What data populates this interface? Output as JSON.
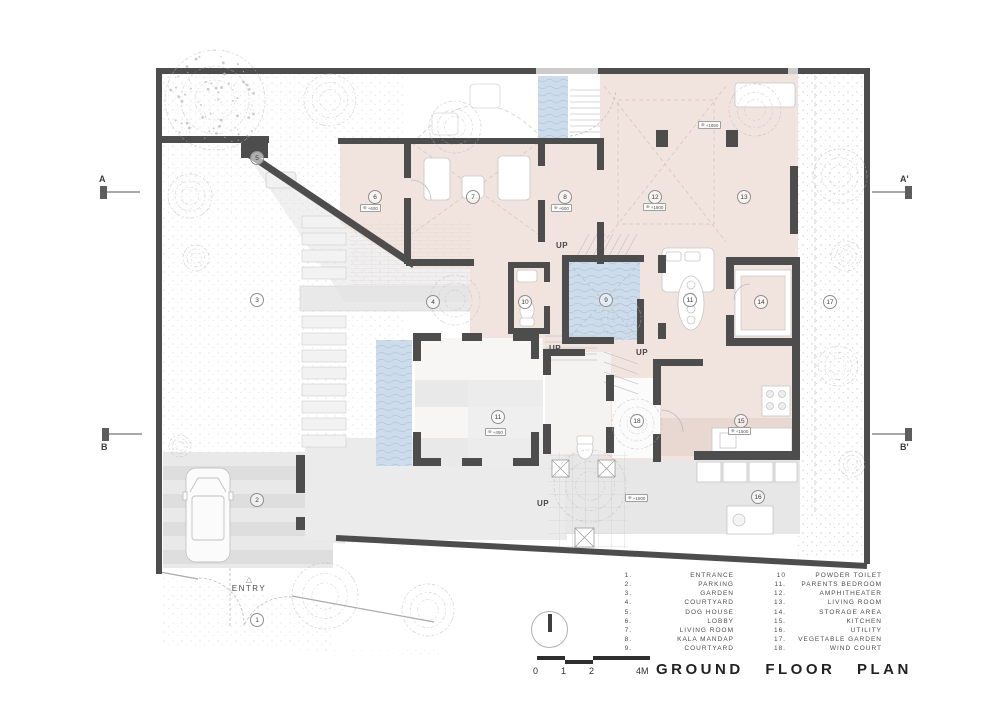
{
  "title": "GROUND FLOOR PLAN",
  "labels": {
    "entry": "ENTRY",
    "up": "UP"
  },
  "colors": {
    "wall": "#4d4d4d",
    "room_fill": "#f1e4df",
    "water": "#cddcea",
    "paving": "#e9e9e9",
    "tree_stroke": "#b8b8b8"
  },
  "section_markers": [
    {
      "label": "A",
      "x": 100,
      "y": 186,
      "side": "left",
      "label_pos": "above"
    },
    {
      "label": "A'",
      "x": 905,
      "y": 186,
      "side": "right",
      "label_pos": "above"
    },
    {
      "label": "B",
      "x": 102,
      "y": 428,
      "side": "left",
      "label_pos": "below"
    },
    {
      "label": "B'",
      "x": 905,
      "y": 428,
      "side": "right",
      "label_pos": "below"
    }
  ],
  "room_markers": [
    {
      "num": "1",
      "x": 257,
      "y": 620
    },
    {
      "num": "2",
      "x": 257,
      "y": 500
    },
    {
      "num": "3",
      "x": 257,
      "y": 300
    },
    {
      "num": "4",
      "x": 433,
      "y": 302
    },
    {
      "num": "5",
      "x": 257,
      "y": 158
    },
    {
      "num": "6",
      "x": 375,
      "y": 197
    },
    {
      "num": "7",
      "x": 473,
      "y": 197
    },
    {
      "num": "8",
      "x": 565,
      "y": 197
    },
    {
      "num": "9",
      "x": 606,
      "y": 300
    },
    {
      "num": "10",
      "x": 525,
      "y": 302
    },
    {
      "num": "11",
      "x": 690,
      "y": 300
    },
    {
      "num": "11",
      "x": 498,
      "y": 417
    },
    {
      "num": "12",
      "x": 655,
      "y": 197
    },
    {
      "num": "13",
      "x": 744,
      "y": 197
    },
    {
      "num": "14",
      "x": 761,
      "y": 302
    },
    {
      "num": "15",
      "x": 741,
      "y": 421
    },
    {
      "num": "16",
      "x": 758,
      "y": 497
    },
    {
      "num": "17",
      "x": 830,
      "y": 302
    },
    {
      "num": "18",
      "x": 637,
      "y": 421
    }
  ],
  "level_tags": [
    {
      "value": "+600",
      "x": 360,
      "y": 204
    },
    {
      "value": "+600",
      "x": 551,
      "y": 204
    },
    {
      "value": "+1800",
      "x": 643,
      "y": 203
    },
    {
      "value": "+1850",
      "x": 698,
      "y": 121
    },
    {
      "value": "+450",
      "x": 485,
      "y": 428
    },
    {
      "value": "+1500",
      "x": 728,
      "y": 427
    },
    {
      "value": "+1500",
      "x": 625,
      "y": 494
    }
  ],
  "up_labels": [
    {
      "x": 556,
      "y": 241
    },
    {
      "x": 549,
      "y": 344
    },
    {
      "x": 636,
      "y": 348
    },
    {
      "x": 537,
      "y": 499
    }
  ],
  "scale_bar": {
    "labels": [
      "0",
      "1",
      "2",
      "4M"
    ]
  },
  "legend": {
    "column1": [
      {
        "num": "1.",
        "name": "ENTRANCE"
      },
      {
        "num": "2.",
        "name": "PARKING"
      },
      {
        "num": "3.",
        "name": "GARDEN"
      },
      {
        "num": "4.",
        "name": "COURTYARD"
      },
      {
        "num": "5.",
        "name": "DOG HOUSE"
      },
      {
        "num": "6.",
        "name": "LOBBY"
      },
      {
        "num": "7.",
        "name": "LIVING ROOM"
      },
      {
        "num": "8.",
        "name": "KALA MANDAP"
      },
      {
        "num": "9.",
        "name": "COURTYARD"
      }
    ],
    "column2": [
      {
        "num": "10",
        "name": "POWDER TOILET"
      },
      {
        "num": "11.",
        "name": "PARENTS BEDROOM"
      },
      {
        "num": "12.",
        "name": "AMPHITHEATER"
      },
      {
        "num": "13.",
        "name": "LIVING ROOM"
      },
      {
        "num": "14.",
        "name": "STORAGE AREA"
      },
      {
        "num": "15.",
        "name": "KITCHEN"
      },
      {
        "num": "16.",
        "name": "UTILITY"
      },
      {
        "num": "17.",
        "name": "VEGETABLE GARDEN"
      },
      {
        "num": "18.",
        "name": "WIND COURT"
      }
    ]
  }
}
